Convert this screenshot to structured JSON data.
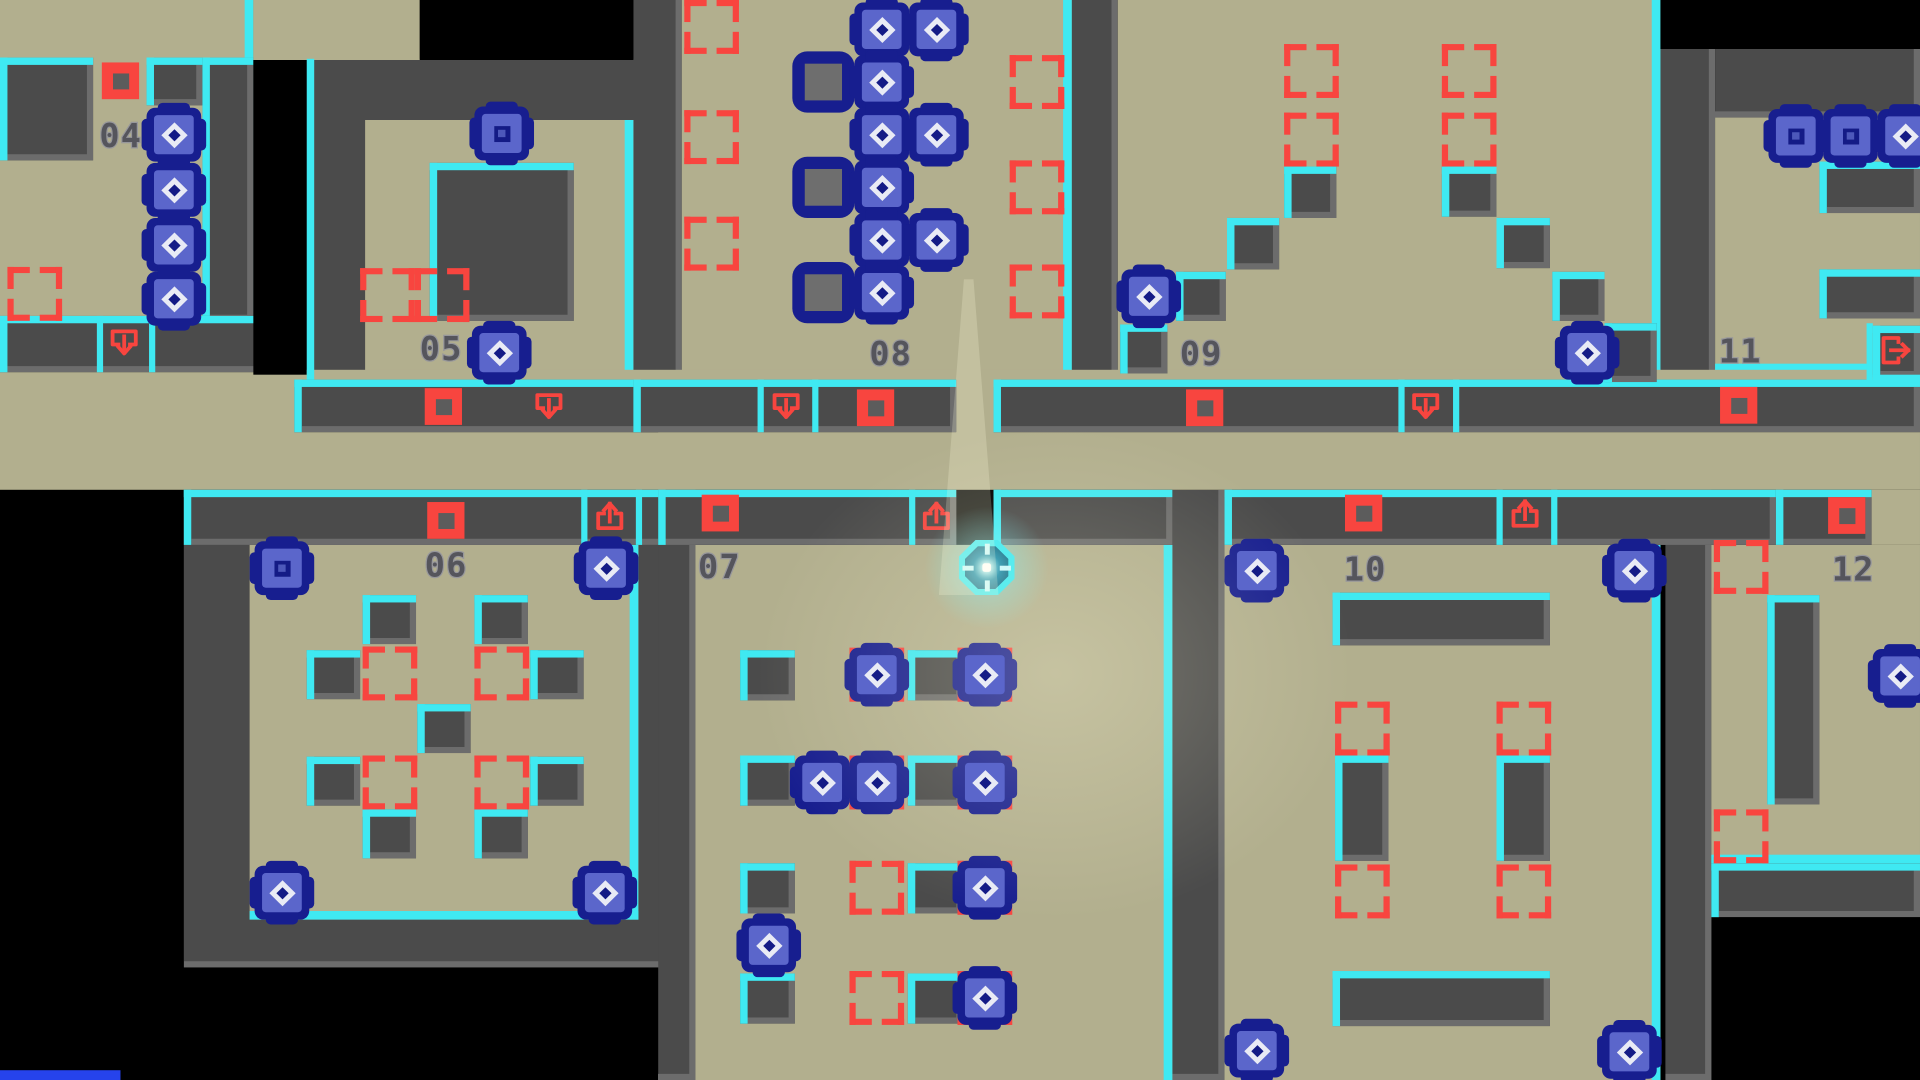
{
  "meta": {
    "title": "tile-puzzle-map",
    "player_room": "07"
  },
  "colors": {
    "floor": "#b2af8e",
    "wall": "#4b4b4b",
    "bevel": "#6c6c6c",
    "cyan": "#3fe9f2",
    "red": "#f8453f",
    "navy": "#171e8f",
    "boxInner": "#5b66cb",
    "blueBar": "#2643ec"
  },
  "labels": [
    {
      "x": 80,
      "y": 98,
      "text": "04"
    },
    {
      "x": 338,
      "y": 272,
      "text": "05"
    },
    {
      "x": 342,
      "y": 449,
      "text": "06"
    },
    {
      "x": 562,
      "y": 450,
      "text": "07"
    },
    {
      "x": 700,
      "y": 276,
      "text": "08"
    },
    {
      "x": 950,
      "y": 276,
      "text": "09"
    },
    {
      "x": 1082,
      "y": 452,
      "text": "10"
    },
    {
      "x": 1384,
      "y": 274,
      "text": "11"
    },
    {
      "x": 1475,
      "y": 452,
      "text": "12"
    }
  ],
  "walls": [
    {
      "x": 247,
      "y": 48,
      "w": 283,
      "h": 262
    },
    {
      "x": 510,
      "y": 0,
      "w": 39,
      "h": 310
    },
    {
      "x": 863,
      "y": 0,
      "w": 37,
      "h": 310
    },
    {
      "x": 1337,
      "y": 40,
      "w": 44,
      "h": 272
    },
    {
      "x": 1381,
      "y": 40,
      "w": 165,
      "h": 56
    },
    {
      "x": 148,
      "y": 445,
      "w": 412,
      "h": 345
    },
    {
      "x": 530,
      "y": 445,
      "w": 30,
      "h": 437
    },
    {
      "x": 944,
      "y": 400,
      "w": 42,
      "h": 482
    },
    {
      "x": 1341,
      "y": 400,
      "w": 37,
      "h": 482
    }
  ],
  "floors": [
    {
      "x": 0,
      "y": 0,
      "w": 204,
      "h": 262,
      "cr": 1
    },
    {
      "x": 204,
      "y": 0,
      "w": 134,
      "h": 49
    },
    {
      "x": 294,
      "y": 98,
      "w": 216,
      "h": 212,
      "cr": 1,
      "cb": 1
    },
    {
      "x": 549,
      "y": 0,
      "w": 314,
      "h": 310,
      "cr": 1,
      "cb": 1
    },
    {
      "x": 900,
      "y": 0,
      "w": 437,
      "h": 310,
      "cr": 1,
      "cb": 1
    },
    {
      "x": 1381,
      "y": 96,
      "w": 165,
      "h": 208,
      "cb": 1
    },
    {
      "x": 0,
      "y": 302,
      "w": 1546,
      "h": 98
    },
    {
      "x": 201,
      "y": 441,
      "w": 313,
      "h": 310,
      "cr": 1,
      "cb": 1
    },
    {
      "x": 560,
      "y": 445,
      "w": 384,
      "h": 437,
      "cr": 1
    },
    {
      "x": 986,
      "y": 445,
      "w": 351,
      "h": 437,
      "cr": 1
    },
    {
      "x": 1378,
      "y": 445,
      "w": 168,
      "h": 260,
      "cb": 1
    },
    {
      "x": 1507,
      "y": 400,
      "w": 39,
      "h": 45
    }
  ],
  "iwalls": [
    {
      "x": 0,
      "y": 47,
      "w": 75,
      "h": 84
    },
    {
      "x": 118,
      "y": 47,
      "w": 45,
      "h": 39
    },
    {
      "x": 163,
      "y": 47,
      "w": 41,
      "h": 215
    },
    {
      "x": 0,
      "y": 258,
      "w": 237,
      "h": 46
    },
    {
      "x": 346,
      "y": 133,
      "w": 116,
      "h": 129
    },
    {
      "x": 237,
      "y": 310,
      "w": 293,
      "h": 43
    },
    {
      "x": 510,
      "y": 310,
      "w": 260,
      "h": 43
    },
    {
      "x": 800,
      "y": 310,
      "w": 746,
      "h": 43
    },
    {
      "x": 148,
      "y": 400,
      "w": 412,
      "h": 45
    },
    {
      "x": 530,
      "y": 400,
      "w": 240,
      "h": 45
    },
    {
      "x": 800,
      "y": 400,
      "w": 144,
      "h": 45
    },
    {
      "x": 986,
      "y": 400,
      "w": 444,
      "h": 45
    },
    {
      "x": 1430,
      "y": 400,
      "w": 77,
      "h": 45
    },
    {
      "x": 292,
      "y": 486,
      "w": 43,
      "h": 40
    },
    {
      "x": 382,
      "y": 486,
      "w": 43,
      "h": 40
    },
    {
      "x": 247,
      "y": 531,
      "w": 43,
      "h": 40
    },
    {
      "x": 427,
      "y": 531,
      "w": 43,
      "h": 40
    },
    {
      "x": 336,
      "y": 575,
      "w": 43,
      "h": 40
    },
    {
      "x": 247,
      "y": 618,
      "w": 43,
      "h": 40
    },
    {
      "x": 427,
      "y": 618,
      "w": 43,
      "h": 40
    },
    {
      "x": 292,
      "y": 661,
      "w": 43,
      "h": 40
    },
    {
      "x": 382,
      "y": 661,
      "w": 43,
      "h": 40
    },
    {
      "x": 596,
      "y": 531,
      "w": 44,
      "h": 41
    },
    {
      "x": 731,
      "y": 531,
      "w": 44,
      "h": 41
    },
    {
      "x": 596,
      "y": 617,
      "w": 44,
      "h": 41
    },
    {
      "x": 731,
      "y": 617,
      "w": 44,
      "h": 41
    },
    {
      "x": 596,
      "y": 705,
      "w": 44,
      "h": 41
    },
    {
      "x": 731,
      "y": 705,
      "w": 44,
      "h": 41
    },
    {
      "x": 596,
      "y": 795,
      "w": 44,
      "h": 41
    },
    {
      "x": 731,
      "y": 795,
      "w": 44,
      "h": 41
    },
    {
      "x": 947,
      "y": 222,
      "w": 40,
      "h": 40
    },
    {
      "x": 988,
      "y": 178,
      "w": 42,
      "h": 42
    },
    {
      "x": 1034,
      "y": 136,
      "w": 42,
      "h": 42
    },
    {
      "x": 1161,
      "y": 136,
      "w": 44,
      "h": 41
    },
    {
      "x": 1205,
      "y": 178,
      "w": 43,
      "h": 41
    },
    {
      "x": 1250,
      "y": 222,
      "w": 42,
      "h": 40
    },
    {
      "x": 902,
      "y": 265,
      "w": 38,
      "h": 40
    },
    {
      "x": 1292,
      "y": 264,
      "w": 42,
      "h": 48
    },
    {
      "x": 1073,
      "y": 484,
      "w": 175,
      "h": 43
    },
    {
      "x": 1075,
      "y": 617,
      "w": 43,
      "h": 86
    },
    {
      "x": 1205,
      "y": 617,
      "w": 43,
      "h": 86
    },
    {
      "x": 1073,
      "y": 793,
      "w": 175,
      "h": 45
    },
    {
      "x": 1465,
      "y": 132,
      "w": 81,
      "h": 42
    },
    {
      "x": 1465,
      "y": 220,
      "w": 81,
      "h": 40
    },
    {
      "x": 1423,
      "y": 486,
      "w": 42,
      "h": 171
    },
    {
      "x": 1378,
      "y": 705,
      "w": 168,
      "h": 44
    },
    {
      "x": 1508,
      "y": 266,
      "w": 38,
      "h": 42
    }
  ],
  "blacks": [
    {
      "x": 204,
      "y": 49,
      "w": 43,
      "h": 257
    },
    {
      "x": 338,
      "y": 0,
      "w": 172,
      "h": 49
    },
    {
      "x": 1337,
      "y": 0,
      "w": 209,
      "h": 40
    }
  ],
  "cyanlines": [
    {
      "x": 247,
      "y": 48,
      "w": 6,
      "h": 262
    },
    {
      "x": 78,
      "y": 258,
      "w": 5,
      "h": 46
    },
    {
      "x": 120,
      "y": 258,
      "w": 5,
      "h": 46
    },
    {
      "x": 610,
      "y": 310,
      "w": 5,
      "h": 43
    },
    {
      "x": 654,
      "y": 310,
      "w": 5,
      "h": 43
    },
    {
      "x": 1126,
      "y": 310,
      "w": 5,
      "h": 43
    },
    {
      "x": 1170,
      "y": 310,
      "w": 5,
      "h": 43
    },
    {
      "x": 468,
      "y": 400,
      "w": 5,
      "h": 45
    },
    {
      "x": 512,
      "y": 400,
      "w": 5,
      "h": 45
    },
    {
      "x": 732,
      "y": 400,
      "w": 5,
      "h": 45
    },
    {
      "x": 1205,
      "y": 400,
      "w": 5,
      "h": 45
    },
    {
      "x": 1249,
      "y": 400,
      "w": 5,
      "h": 45
    },
    {
      "x": 1503,
      "y": 264,
      "w": 5,
      "h": 48
    },
    {
      "x": 1508,
      "y": 306,
      "w": 38,
      "h": 6
    }
  ],
  "targets": [
    {
      "x": 6,
      "y": 218
    },
    {
      "x": 290,
      "y": 219
    },
    {
      "x": 334,
      "y": 219
    },
    {
      "x": 551,
      "y": 0
    },
    {
      "x": 551,
      "y": 90
    },
    {
      "x": 551,
      "y": 177
    },
    {
      "x": 813,
      "y": 45
    },
    {
      "x": 813,
      "y": 131
    },
    {
      "x": 813,
      "y": 216
    },
    {
      "x": 1034,
      "y": 36
    },
    {
      "x": 1161,
      "y": 36
    },
    {
      "x": 1034,
      "y": 92
    },
    {
      "x": 1161,
      "y": 92
    },
    {
      "x": 292,
      "y": 528
    },
    {
      "x": 382,
      "y": 528
    },
    {
      "x": 292,
      "y": 617
    },
    {
      "x": 382,
      "y": 617
    },
    {
      "x": 684,
      "y": 703
    },
    {
      "x": 684,
      "y": 793
    },
    {
      "x": 1075,
      "y": 573
    },
    {
      "x": 1205,
      "y": 573
    },
    {
      "x": 1075,
      "y": 706
    },
    {
      "x": 1205,
      "y": 706
    },
    {
      "x": 1380,
      "y": 441
    },
    {
      "x": 1380,
      "y": 661
    }
  ],
  "sockets": [
    {
      "x": 641,
      "y": 45
    },
    {
      "x": 641,
      "y": 131
    },
    {
      "x": 641,
      "y": 217
    }
  ],
  "boxes": [
    {
      "x": 118,
      "y": 88,
      "icon": "diamond"
    },
    {
      "x": 118,
      "y": 133,
      "icon": "diamond"
    },
    {
      "x": 118,
      "y": 178,
      "icon": "diamond"
    },
    {
      "x": 118,
      "y": 222,
      "icon": "diamond"
    },
    {
      "x": 382,
      "y": 87,
      "icon": "square"
    },
    {
      "x": 380,
      "y": 266,
      "icon": "diamond"
    },
    {
      "x": 205,
      "y": 442,
      "icon": "square"
    },
    {
      "x": 466,
      "y": 442,
      "icon": "diamond"
    },
    {
      "x": 205,
      "y": 707,
      "icon": "diamond"
    },
    {
      "x": 465,
      "y": 707,
      "icon": "diamond"
    },
    {
      "x": 688,
      "y": 2,
      "icon": "diamond"
    },
    {
      "x": 732,
      "y": 2,
      "icon": "diamond"
    },
    {
      "x": 688,
      "y": 45,
      "icon": "diamond"
    },
    {
      "x": 688,
      "y": 88,
      "icon": "diamond"
    },
    {
      "x": 732,
      "y": 88,
      "icon": "diamond"
    },
    {
      "x": 688,
      "y": 131,
      "icon": "diamond"
    },
    {
      "x": 688,
      "y": 174,
      "icon": "diamond"
    },
    {
      "x": 732,
      "y": 174,
      "icon": "diamond"
    },
    {
      "x": 688,
      "y": 217,
      "icon": "diamond"
    },
    {
      "x": 684,
      "y": 529,
      "icon": "diamond",
      "onTarget": 1
    },
    {
      "x": 771,
      "y": 529,
      "icon": "diamond",
      "onTarget": 1
    },
    {
      "x": 640,
      "y": 617,
      "icon": "diamond"
    },
    {
      "x": 684,
      "y": 617,
      "icon": "diamond",
      "onTarget": 1
    },
    {
      "x": 771,
      "y": 617,
      "icon": "diamond",
      "onTarget": 1
    },
    {
      "x": 771,
      "y": 703,
      "icon": "diamond",
      "onTarget": 1
    },
    {
      "x": 597,
      "y": 750,
      "icon": "diamond"
    },
    {
      "x": 771,
      "y": 793,
      "icon": "diamond",
      "onTarget": 1
    },
    {
      "x": 903,
      "y": 220,
      "icon": "diamond"
    },
    {
      "x": 1256,
      "y": 266,
      "icon": "diamond"
    },
    {
      "x": 990,
      "y": 444,
      "icon": "diamond"
    },
    {
      "x": 1294,
      "y": 444,
      "icon": "diamond"
    },
    {
      "x": 990,
      "y": 836,
      "icon": "diamond"
    },
    {
      "x": 1290,
      "y": 837,
      "icon": "diamond"
    },
    {
      "x": 1424,
      "y": 89,
      "icon": "square"
    },
    {
      "x": 1468,
      "y": 89,
      "icon": "square"
    },
    {
      "x": 1512,
      "y": 89,
      "icon": "diamond"
    },
    {
      "x": 1508,
      "y": 530,
      "icon": "diamond"
    }
  ],
  "markers": [
    {
      "x": 82,
      "y": 51
    },
    {
      "x": 342,
      "y": 317
    },
    {
      "x": 690,
      "y": 318
    },
    {
      "x": 955,
      "y": 318
    },
    {
      "x": 344,
      "y": 410
    },
    {
      "x": 565,
      "y": 404
    },
    {
      "x": 1083,
      "y": 404
    },
    {
      "x": 1385,
      "y": 316
    },
    {
      "x": 1472,
      "y": 406
    }
  ],
  "icons": [
    {
      "x": 84,
      "y": 264,
      "type": "down"
    },
    {
      "x": 426,
      "y": 316,
      "type": "down"
    },
    {
      "x": 617,
      "y": 316,
      "type": "down"
    },
    {
      "x": 1132,
      "y": 316,
      "type": "down"
    },
    {
      "x": 475,
      "y": 406,
      "type": "up"
    },
    {
      "x": 738,
      "y": 406,
      "type": "up"
    },
    {
      "x": 1212,
      "y": 404,
      "type": "up"
    },
    {
      "x": 1510,
      "y": 270,
      "type": "exit"
    }
  ],
  "player": {
    "x": 772,
    "y": 441,
    "size": 45
  },
  "lights": {
    "wedge": {
      "x": 756,
      "y": 228,
      "w": 48,
      "h": 258
    },
    "glow": {
      "x": 600,
      "y": 340,
      "w": 500,
      "h": 420
    }
  },
  "bluebar": {
    "x": 0,
    "y": 874,
    "w": 97,
    "h": 8
  }
}
